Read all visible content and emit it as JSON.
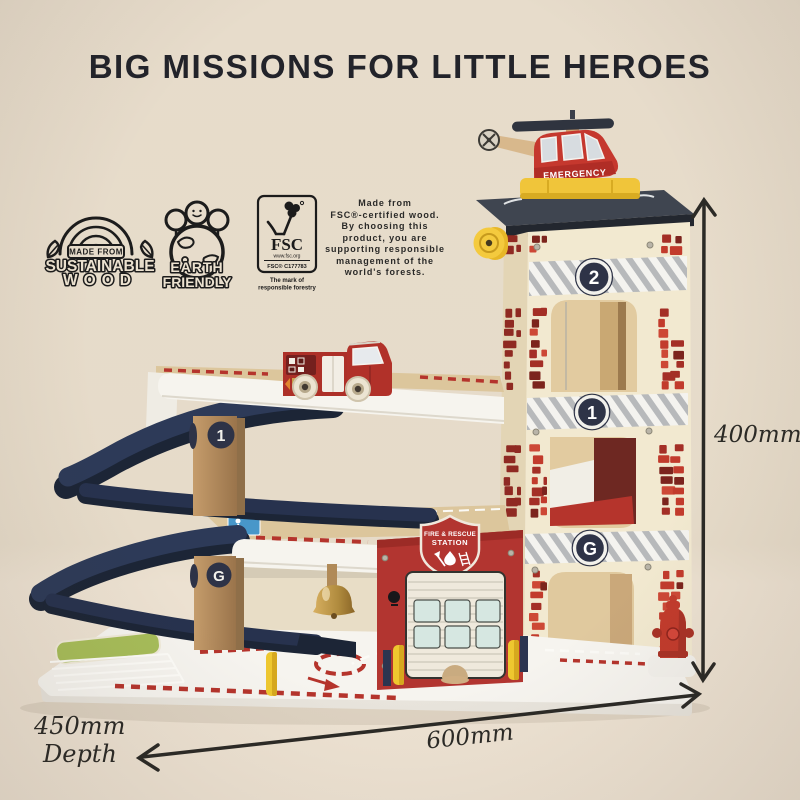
{
  "page": {
    "title": "BIG MISSIONS FOR LITTLE HEROES"
  },
  "eco_badges": {
    "sustainable_wood": {
      "top": "MADE FROM",
      "line1": "SUSTAINABLE",
      "line2": "WOOD"
    },
    "earth_friendly": {
      "line1": "EARTH",
      "line2": "FRIENDLY"
    },
    "fsc": {
      "name": "FSC",
      "url": "www.fsc.org",
      "license": "FSC® C177783",
      "tagline_line1": "The mark of",
      "tagline_line2": "responsible forestry"
    },
    "statement": "Made from\nFSC®-certified wood.\nBy choosing this\nproduct, you are\nsupporting responsible\nmanagement of the\nworld's forests."
  },
  "toy": {
    "helicopter_label": "EMERGENCY",
    "station_badge_line1": "FIRE & RESCUE",
    "station_badge_line2": "STATION",
    "tower_floor_2": "2",
    "tower_floor_1": "1",
    "tower_floor_g": "G",
    "column_floor_1": "1",
    "column_floor_g": "G"
  },
  "dimensions": {
    "height": "400mm",
    "width": "600mm",
    "depth_value": "450mm",
    "depth_label": "Depth"
  },
  "colors": {
    "background": "#e7dccb",
    "title_text": "#22232a",
    "brick_red": "#c23b2c",
    "station_red": "#b23530",
    "ramp_navy": "#2c3752",
    "accent_yellow": "#f0c53a",
    "wood_cream": "#f2e9d0",
    "dimension_ink": "#2b2a26"
  }
}
